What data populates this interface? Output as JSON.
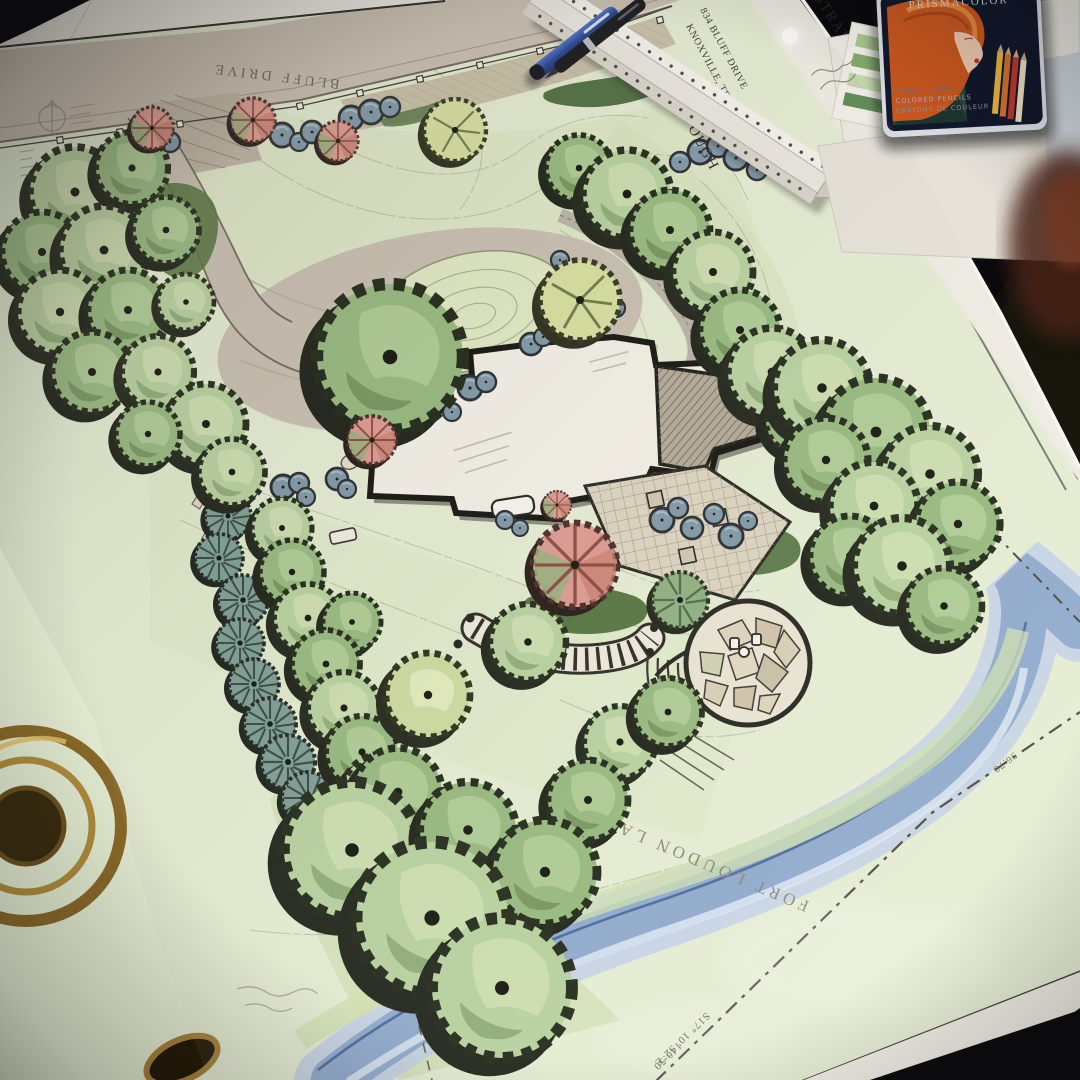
{
  "plan": {
    "sheet_title": "ILLUSTRATIVE MASTER PLAN",
    "address": "834 BLUFF DRIVE",
    "city": "KNOXVILLE, TENNESSEE",
    "client_name_partial": "OUGH",
    "road_label": "BLUFF DRIVE",
    "water_label": "FORT LOUDON LAKE",
    "property_line": {
      "bearing": "S17° 10' 52\"E",
      "distance": "140.50",
      "distance_2": "96.70"
    }
  },
  "objects": {
    "pencil_tin_brand": "PRISMACOLOR",
    "pencil_tin_line1": "COLORED PENCILS",
    "pencil_tin_line2": "CRAYONS DE COULEUR"
  },
  "colors": {
    "table": "#0d0d10",
    "paper": "#efece4",
    "lawn": "#e4ecd2",
    "road": "#c8bfb1",
    "canopy_light": "#b7d09e",
    "canopy_mid": "#96b87e",
    "conifer": "#7f9d94",
    "shrub_blue": "#7f98a6",
    "ornamental_pink": "#dc9a90",
    "water": "#8fa9cc",
    "border_maroon": "#33222a"
  }
}
